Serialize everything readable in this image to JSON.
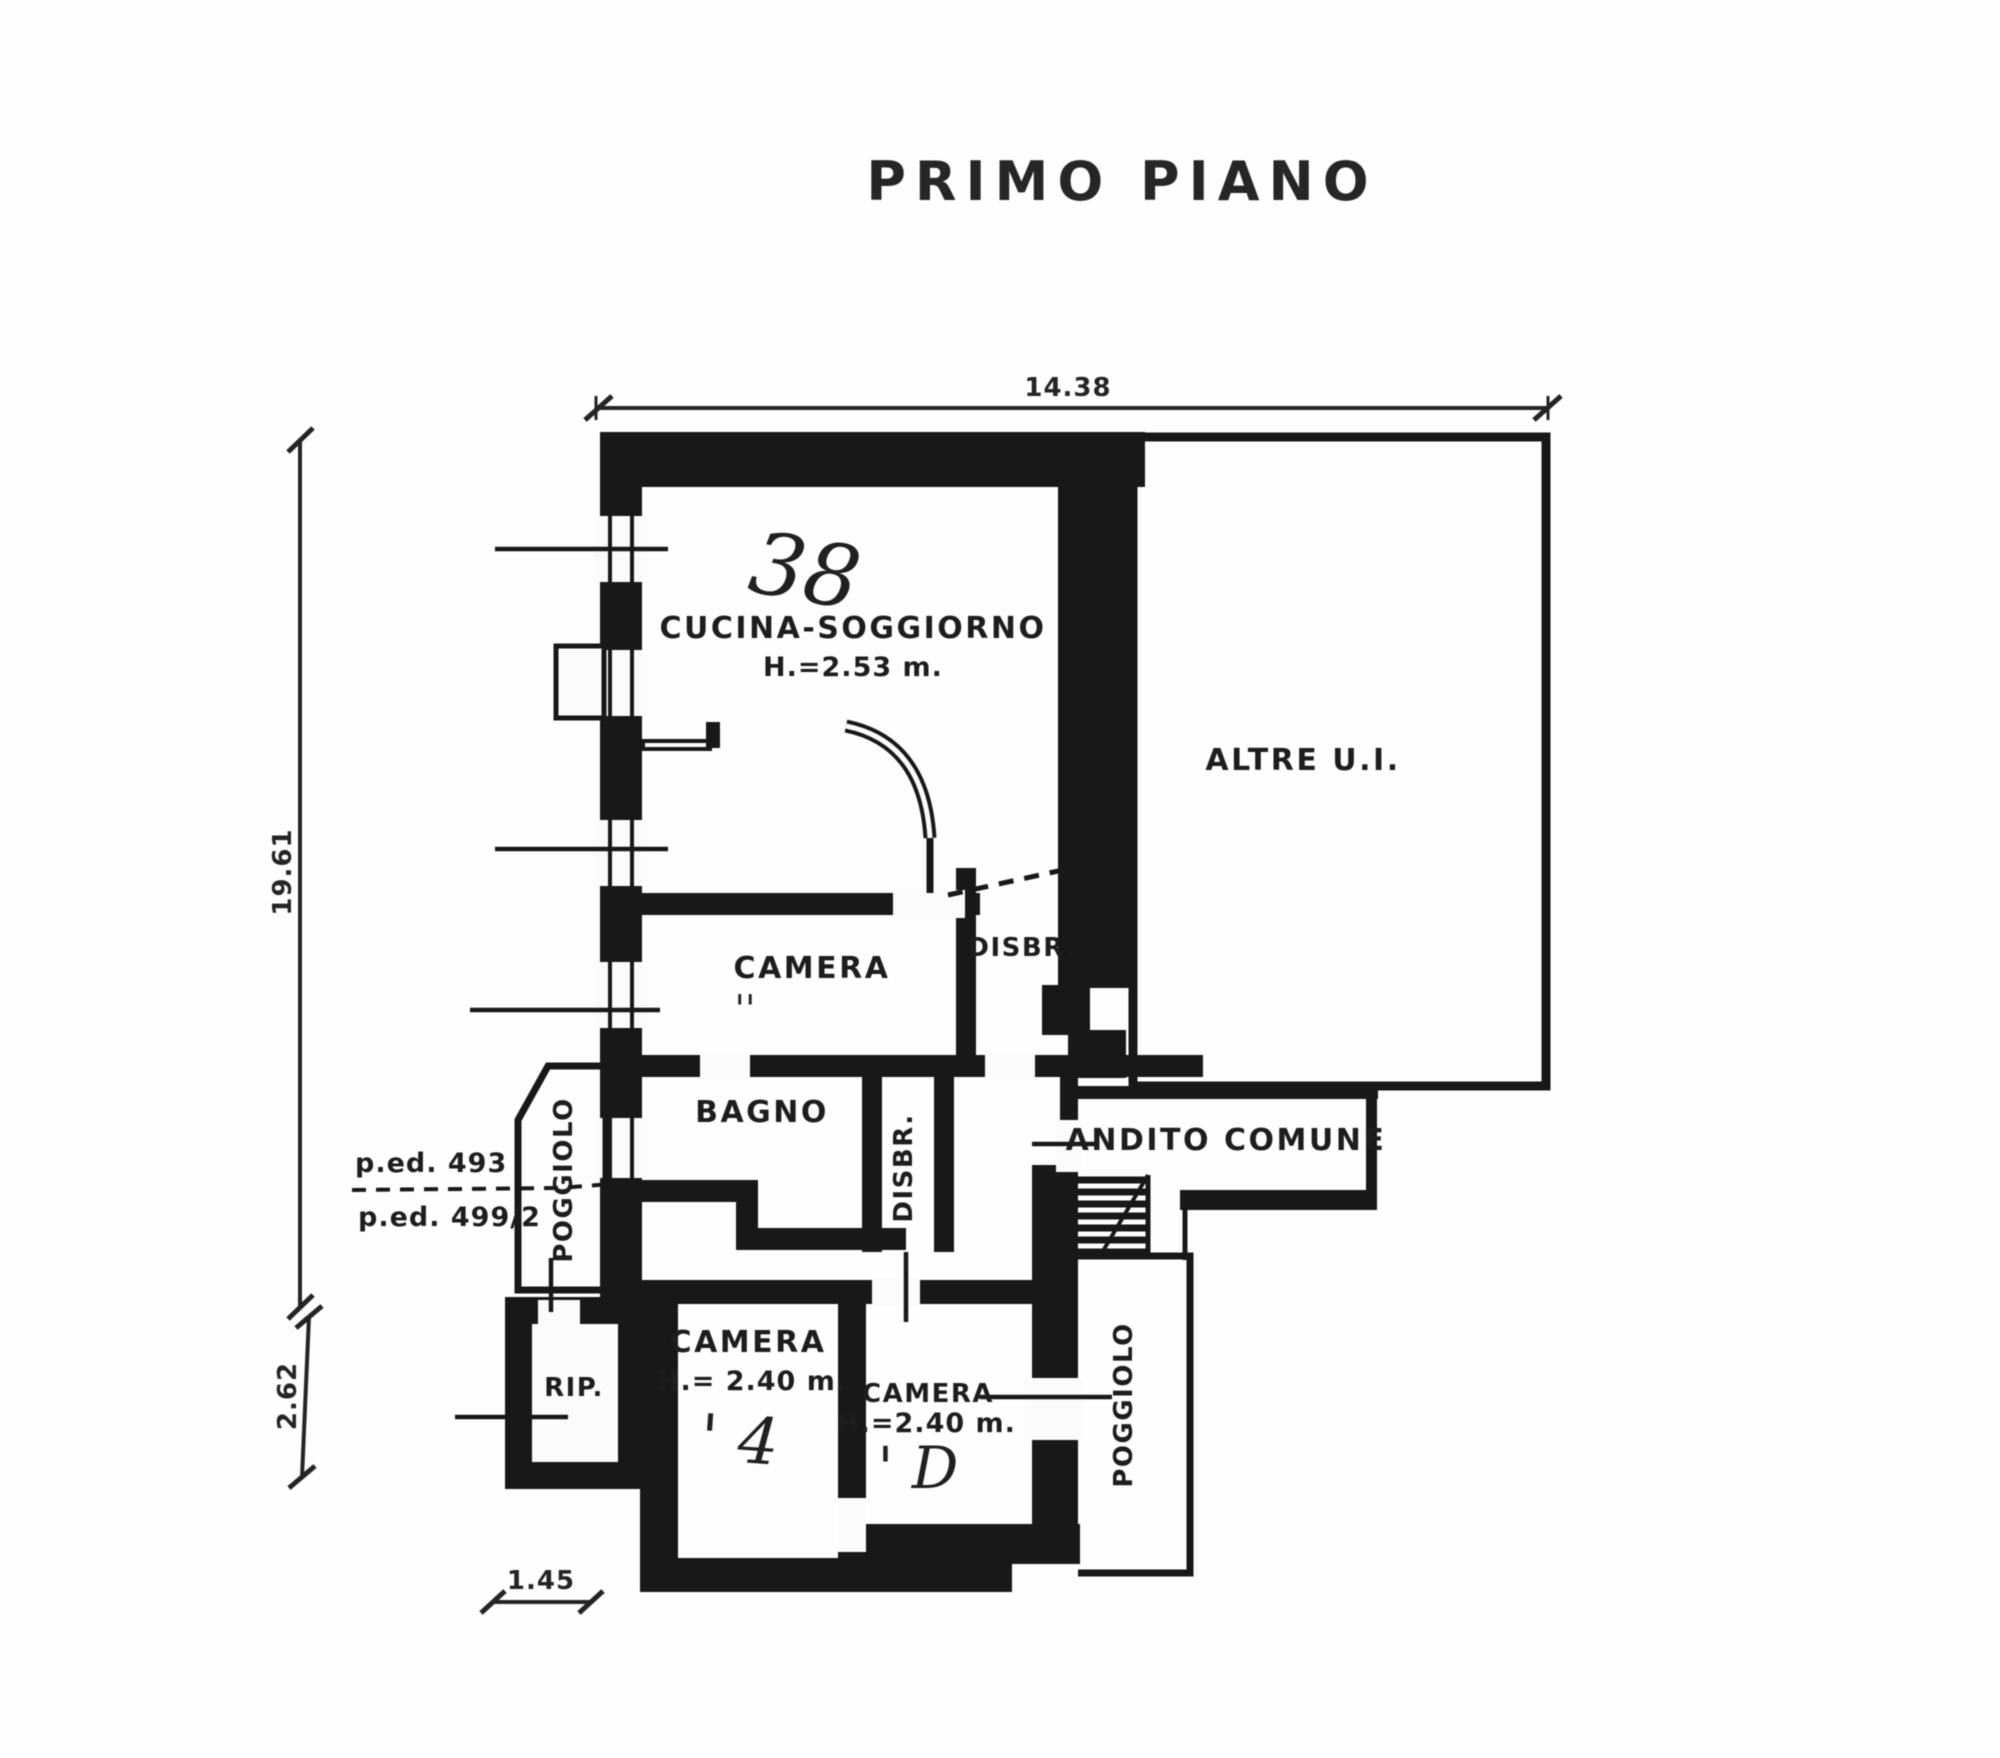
{
  "document": {
    "title": "PRIMO PIANO",
    "ink_color": "#161616",
    "paper_color": "#fefefe"
  },
  "rooms": {
    "cucina": {
      "label": "CUCINA-SOGGIORNO",
      "height": "H.=2.53 m."
    },
    "camera_mid": {
      "label": "CAMERA"
    },
    "disbr": {
      "label": "DISBR."
    },
    "bagno": {
      "label": "BAGNO"
    },
    "disbr_vertical": {
      "label": "DISBR."
    },
    "andito": {
      "label": "ANDITO COMUNE"
    },
    "poggiolo_left": {
      "label": "POGGIOLO"
    },
    "rip": {
      "label": "RIP."
    },
    "camera_left": {
      "label": "CAMERA",
      "height": "H.= 2.40 m."
    },
    "camera_right": {
      "label": "CAMERA",
      "height": "H.=2.40 m."
    },
    "poggiolo_right": {
      "label": "POGGIOLO"
    },
    "altre": {
      "label": "ALTRE U.I."
    }
  },
  "dimensions": {
    "top": "14.38",
    "left": "19.61",
    "left_lower": "2.62",
    "bottom": "1.45"
  },
  "parcels": {
    "upper": "p.ed. 493",
    "lower": "p.ed. 499/2"
  },
  "handwritten": {
    "unit_number": "38",
    "camera_mid_mark": "''",
    "camera_left_mark": "' 4",
    "camera_right_mark": "' D"
  }
}
